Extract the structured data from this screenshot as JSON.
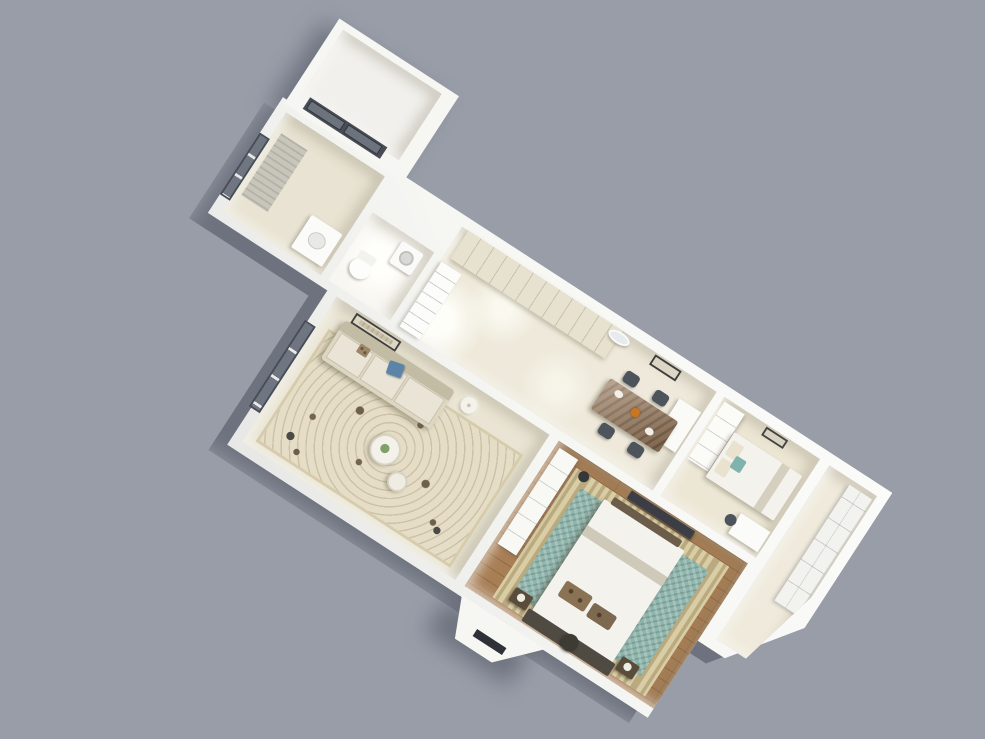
{
  "scene": {
    "description": "3D isometric render of a one-story apartment floor plan, rotated diagonally on a plain gray backdrop",
    "background_color": "#989da8",
    "wall_color": "#f6f6f3",
    "rotation_deg": 33,
    "view": "top-down axonometric cutaway"
  },
  "rooms": [
    {
      "id": "balcony",
      "name": "Balcony",
      "floor_color": "#f1f0ec",
      "furniture": [
        "sliding-glass-door"
      ]
    },
    {
      "id": "bathroom",
      "name": "Bathroom",
      "floor_color": "#e8e3d2",
      "furniture": [
        "window-with-gray-blind",
        "white-vanity"
      ]
    },
    {
      "id": "wc",
      "name": "WC / Laundry",
      "floor_color": "#f6f4ec",
      "furniture": [
        "toilet",
        "washing-machine"
      ]
    },
    {
      "id": "hall_dining",
      "name": "Entry Hall & Dining",
      "floor_color": "#eee9da",
      "furniture": [
        "built-in-cream-wardrobe",
        "open-shelf-unit",
        "marble-dining-table",
        "four-dark-chairs",
        "oval-mirror",
        "framed-picture",
        "white-cabinet",
        "amber-vase"
      ]
    },
    {
      "id": "second_bedroom",
      "name": "Second Bedroom",
      "floor_color": "#ece6d4",
      "furniture": [
        "single-bed-white-duvet",
        "teal-pillow",
        "white-wardrobe",
        "desk-with-chair",
        "framed-picture"
      ]
    },
    {
      "id": "closet_room",
      "name": "Bathroom / Built-in Closet",
      "floor_color": "#efeadb",
      "furniture": [
        "white-paneled-cabinets"
      ]
    },
    {
      "id": "living_room",
      "name": "Living Room",
      "floor_color": "#e9e4d3",
      "furniture": [
        "beige-sofa",
        "blue-accent-pillow",
        "patterned-area-rug",
        "round-coffee-tables",
        "white-floor-lamp",
        "framed-architecture-print",
        "window",
        "floor-decor"
      ]
    },
    {
      "id": "master_bedroom",
      "name": "Master Bedroom",
      "floor_color": "#a87e55",
      "furniture": [
        "double-bed-white-duvet",
        "dark-headboard",
        "patterned-pillows",
        "teal-ornate-rug",
        "wall-tv",
        "white-wardrobe",
        "nightstands-with-lamps",
        "dark-stool",
        "black-floor-lamp",
        "foot-bench"
      ]
    }
  ],
  "palette": {
    "window_frame": "#474c55",
    "glass_dark": "#707681",
    "blind_gray": "#c8c5bb",
    "sofa_beige": "#ddd6c1",
    "pillow_blue": "#5b84a8",
    "duvet_white": "#f4f2ec",
    "headboard_dark": "#4f4a42",
    "tv_dark": "#3b3f45",
    "marble_table": "#97785a",
    "chair_dark": "#4e545c",
    "rug_border_beige": "#d9cda6",
    "rug_teal": "#8fb5ac",
    "pillow_teal": "#7fb3ad",
    "wood_floor": "#a87e55"
  }
}
